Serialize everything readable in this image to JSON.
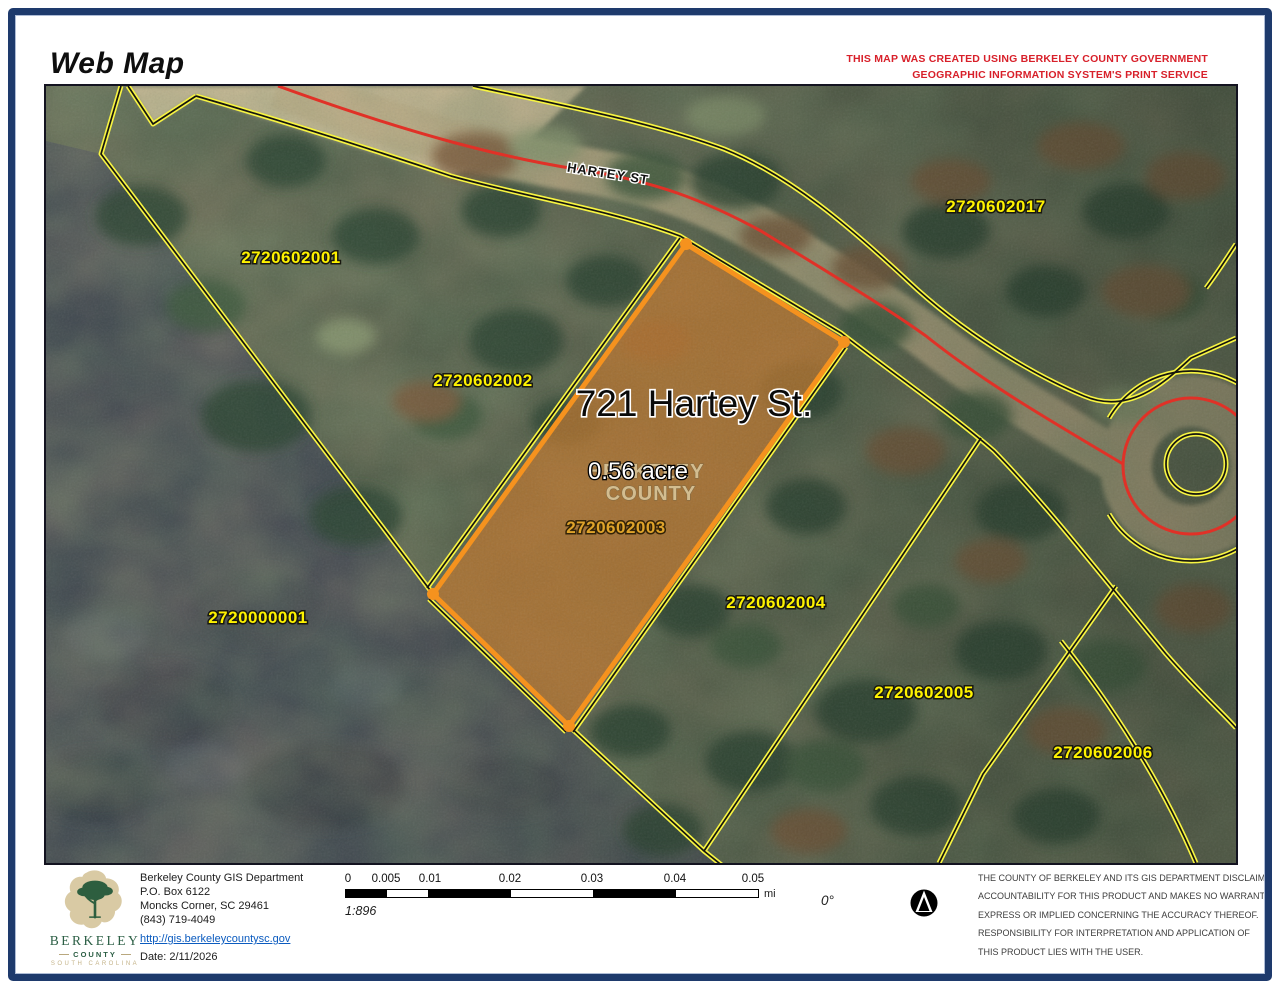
{
  "header": {
    "title": "Web Map",
    "notice_line1": "THIS MAP WAS CREATED USING BERKELEY COUNTY GOVERNMENT",
    "notice_line2": "GEOGRAPHIC INFORMATION SYSTEM'S PRINT SERVICE"
  },
  "map": {
    "street_label": "HARTEY ST",
    "subject_parcel": {
      "address_label": "721 Hartey St.",
      "area_label": "0.56 acre",
      "parcel_id": "2720602003"
    },
    "watermark_line1": "BERKELEY",
    "watermark_line2": "COUNTY",
    "parcel_labels": [
      {
        "id": "2720602001"
      },
      {
        "id": "2720602002"
      },
      {
        "id": "2720602017"
      },
      {
        "id": "2720602004"
      },
      {
        "id": "2720602005"
      },
      {
        "id": "2720602006"
      },
      {
        "id": "2720000001"
      }
    ],
    "highlight_color": "#f5921e",
    "parcel_line_color": "#f7f442",
    "road_centerline_color": "#e03127"
  },
  "footer": {
    "logo": {
      "line1": "BERKELEY",
      "line2": "COUNTY",
      "line3": "SOUTH CAROLINA"
    },
    "department_lines": [
      "Berkeley County GIS Department",
      "P.O. Box 6122",
      "Moncks Corner, SC 29461",
      "(843) 719-4049"
    ],
    "website": "http://gis.berkeleycountysc.gov",
    "date_label": "Date: 2/11/2026",
    "scale_bar": {
      "tick_labels": [
        "0",
        "0.005",
        "0.01",
        "0.02",
        "0.03",
        "0.04",
        "0.05"
      ],
      "unit": "mi",
      "scale_ratio": "1:896"
    },
    "rotation_label": "0°",
    "disclaimer_lines": [
      "THE COUNTY OF BERKELEY AND ITS GIS DEPARTMENT DISCLAIMS",
      "ACCOUNTABILITY FOR THIS PRODUCT AND MAKES NO WARRANTY",
      "EXPRESS OR IMPLIED CONCERNING THE ACCURACY THEREOF.",
      "RESPONSIBILITY FOR INTERPRETATION AND APPLICATION OF",
      "THIS PRODUCT LIES WITH THE USER."
    ]
  }
}
